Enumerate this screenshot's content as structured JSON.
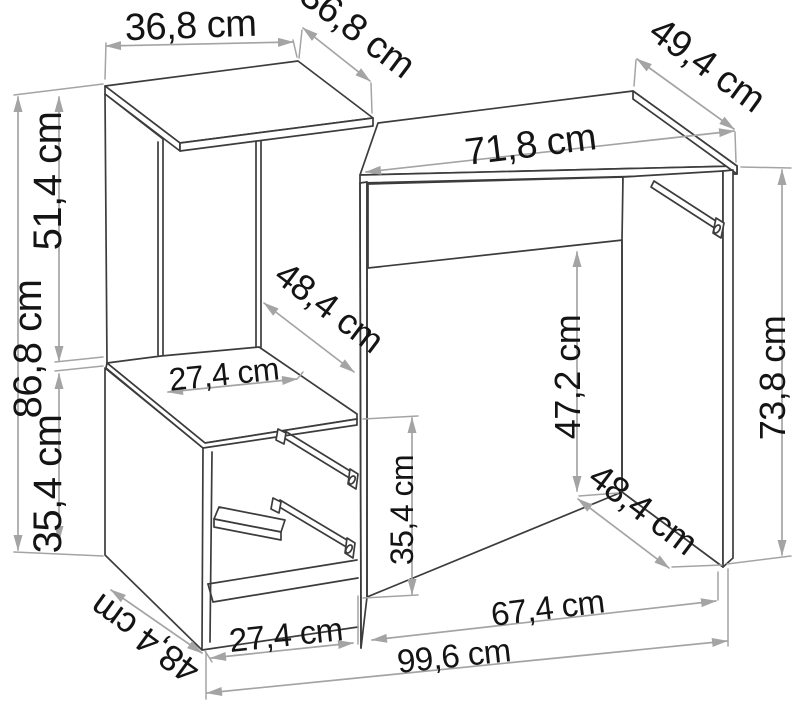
{
  "diagram": {
    "type": "furniture-dimension-drawing",
    "subject": "desk with shelf tower and drawer cabinet",
    "unit": "cm",
    "colors": {
      "background": "#ffffff",
      "outline": "#3c3c3c",
      "dimension_lines": "#a4a4a4",
      "label_text": "#141414"
    }
  },
  "dimensions": {
    "shelf_top_width": {
      "label": "36,8 cm",
      "value": 36.8
    },
    "shelf_top_depth": {
      "label": "36,8 cm",
      "value": 36.8
    },
    "desk_top_depth": {
      "label": "49,4 cm",
      "value": 49.4
    },
    "desk_top_width": {
      "label": "71,8 cm",
      "value": 71.8
    },
    "tower_upper_height": {
      "label": "51,4 cm",
      "value": 51.4
    },
    "tower_total_height": {
      "label": "86,8 cm",
      "value": 86.8
    },
    "tower_lower_height": {
      "label": "35,4 cm",
      "value": 35.4
    },
    "compartment_depth": {
      "label": "48,4 cm",
      "value": 48.4
    },
    "cabinet_top_width": {
      "label": "27,4 cm",
      "value": 27.4
    },
    "under_desk_clearance": {
      "label": "47,2 cm",
      "value": 47.2
    },
    "desk_height": {
      "label": "73,8 cm",
      "value": 73.8
    },
    "cabinet_inner_height": {
      "label": "35,4 cm",
      "value": 35.4
    },
    "cabinet_bottom_depth": {
      "label": "48,4 cm",
      "value": 48.4
    },
    "right_panel_depth": {
      "label": "48,4 cm",
      "value": 48.4
    },
    "cabinet_bottom_width": {
      "label": "27,4 cm",
      "value": 27.4
    },
    "desk_section_width": {
      "label": "67,4 cm",
      "value": 67.4
    },
    "total_width": {
      "label": "99,6 cm",
      "value": 99.6
    }
  }
}
